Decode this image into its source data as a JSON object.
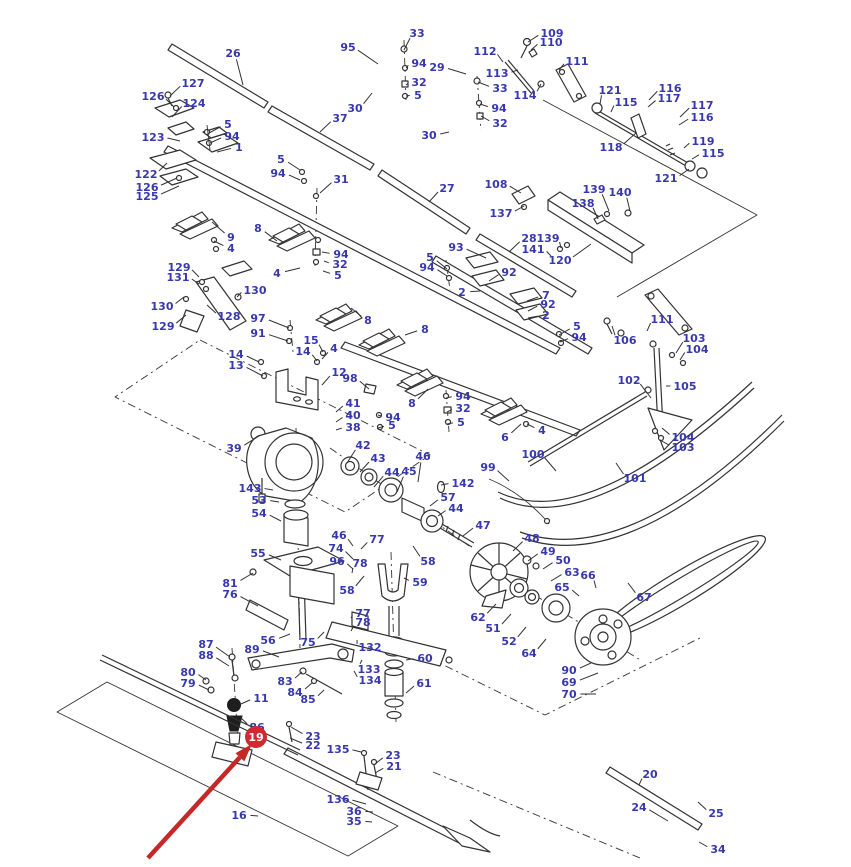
{
  "figure": {
    "label_color": "#3838ae",
    "line_color": "#333333",
    "background": "#ffffff",
    "callout_fields": [
      "text",
      "x",
      "y",
      "leader_x",
      "leader_y"
    ]
  },
  "highlight": {
    "badge_text": "19",
    "badge_color": "#d02a30",
    "badge_text_color": "#ffffff",
    "badge_x": 256,
    "badge_y": 737,
    "badge_r": 11,
    "arrow_color": "#c62828",
    "arrow": {
      "x1": 148,
      "y1": 858,
      "x2": 252,
      "y2": 744
    }
  },
  "callouts": [
    [
      "26",
      233,
      53,
      243,
      85
    ],
    [
      "127",
      193,
      83,
      170,
      96
    ],
    [
      "126",
      153,
      96,
      174,
      107
    ],
    [
      "124",
      194,
      103,
      172,
      117
    ],
    [
      "123",
      153,
      137,
      180,
      141
    ],
    [
      "5",
      228,
      124,
      209,
      133
    ],
    [
      "94",
      232,
      136,
      210,
      143
    ],
    [
      "1",
      239,
      147,
      217,
      152
    ],
    [
      "122",
      146,
      174,
      167,
      163
    ],
    [
      "126",
      147,
      187,
      177,
      178
    ],
    [
      "125",
      147,
      196,
      179,
      186
    ],
    [
      "9",
      231,
      237,
      212,
      222
    ],
    [
      "4",
      231,
      248,
      214,
      241
    ],
    [
      "129",
      179,
      267,
      199,
      277
    ],
    [
      "131",
      178,
      277,
      199,
      284
    ],
    [
      "130",
      255,
      290,
      237,
      297
    ],
    [
      "130",
      162,
      306,
      184,
      297
    ],
    [
      "128",
      229,
      316,
      207,
      305
    ],
    [
      "129",
      163,
      326,
      186,
      315
    ],
    [
      "95",
      348,
      47,
      378,
      64
    ],
    [
      "33",
      417,
      33,
      404,
      50
    ],
    [
      "94",
      419,
      63,
      406,
      68
    ],
    [
      "32",
      419,
      82,
      406,
      85
    ],
    [
      "5",
      418,
      95,
      406,
      96
    ],
    [
      "30",
      355,
      108,
      372,
      93
    ],
    [
      "37",
      340,
      118,
      320,
      132
    ],
    [
      "29",
      437,
      67,
      466,
      74
    ],
    [
      "33",
      500,
      88,
      478,
      82
    ],
    [
      "94",
      499,
      108,
      480,
      104
    ],
    [
      "32",
      500,
      123,
      481,
      116
    ],
    [
      "30",
      429,
      135,
      449,
      132
    ],
    [
      "109",
      552,
      33,
      528,
      42
    ],
    [
      "110",
      551,
      42,
      531,
      50
    ],
    [
      "112",
      485,
      51,
      503,
      62
    ],
    [
      "113",
      497,
      73,
      518,
      70
    ],
    [
      "111",
      577,
      61,
      559,
      70
    ],
    [
      "114",
      525,
      95,
      541,
      84
    ],
    [
      "121",
      610,
      90,
      600,
      104
    ],
    [
      "115",
      626,
      102,
      611,
      112
    ],
    [
      "116",
      670,
      88,
      649,
      100
    ],
    [
      "117",
      669,
      98,
      648,
      107
    ],
    [
      "117",
      702,
      105,
      680,
      117
    ],
    [
      "116",
      702,
      117,
      679,
      125
    ],
    [
      "119",
      703,
      141,
      684,
      148
    ],
    [
      "115",
      713,
      153,
      692,
      159
    ],
    [
      "121",
      666,
      178,
      689,
      169
    ],
    [
      "118",
      611,
      147,
      636,
      133
    ],
    [
      "139",
      594,
      189,
      609,
      211
    ],
    [
      "140",
      620,
      192,
      630,
      211
    ],
    [
      "108",
      496,
      184,
      521,
      193
    ],
    [
      "137",
      501,
      213,
      524,
      206
    ],
    [
      "27",
      447,
      188,
      429,
      202
    ],
    [
      "138",
      583,
      203,
      598,
      219
    ],
    [
      "28",
      529,
      238,
      509,
      252
    ],
    [
      "139",
      548,
      238,
      561,
      248
    ],
    [
      "141",
      533,
      249,
      551,
      256
    ],
    [
      "120",
      560,
      260,
      591,
      244
    ],
    [
      "93",
      456,
      247,
      486,
      258
    ],
    [
      "5",
      430,
      257,
      447,
      269
    ],
    [
      "94",
      427,
      267,
      447,
      276
    ],
    [
      "92",
      509,
      272,
      489,
      281
    ],
    [
      "2",
      462,
      292,
      480,
      291
    ],
    [
      "7",
      546,
      295,
      527,
      301
    ],
    [
      "92",
      548,
      304,
      528,
      311
    ],
    [
      "2",
      546,
      315,
      528,
      318
    ],
    [
      "5",
      577,
      326,
      559,
      335
    ],
    [
      "94",
      579,
      337,
      560,
      342
    ],
    [
      "111",
      662,
      319,
      647,
      331
    ],
    [
      "106",
      625,
      340,
      612,
      326
    ],
    [
      "103",
      694,
      338,
      676,
      353
    ],
    [
      "104",
      697,
      349,
      680,
      360
    ],
    [
      "105",
      685,
      386,
      666,
      386
    ],
    [
      "102",
      629,
      380,
      651,
      398
    ],
    [
      "104",
      683,
      437,
      662,
      428
    ],
    [
      "103",
      683,
      447,
      660,
      440
    ],
    [
      "31",
      341,
      179,
      320,
      193
    ],
    [
      "8",
      258,
      228,
      277,
      241
    ],
    [
      "4",
      277,
      273,
      300,
      268
    ],
    [
      "94",
      341,
      254,
      322,
      252
    ],
    [
      "32",
      340,
      264,
      324,
      261
    ],
    [
      "5",
      338,
      275,
      323,
      271
    ],
    [
      "5",
      281,
      159,
      300,
      170
    ],
    [
      "94",
      278,
      173,
      300,
      180
    ],
    [
      "97",
      258,
      318,
      289,
      328
    ],
    [
      "91",
      258,
      333,
      288,
      341
    ],
    [
      "14",
      236,
      354,
      259,
      362
    ],
    [
      "13",
      236,
      365,
      263,
      376
    ],
    [
      "15",
      311,
      340,
      323,
      352
    ],
    [
      "14",
      303,
      351,
      317,
      361
    ],
    [
      "4",
      334,
      348,
      322,
      359
    ],
    [
      "12",
      339,
      372,
      322,
      385
    ],
    [
      "98",
      350,
      378,
      369,
      389
    ],
    [
      "8",
      368,
      320,
      351,
      308
    ],
    [
      "8",
      425,
      329,
      405,
      335
    ],
    [
      "41",
      353,
      403,
      336,
      412
    ],
    [
      "40",
      353,
      415,
      336,
      422
    ],
    [
      "38",
      353,
      427,
      336,
      430
    ],
    [
      "8",
      412,
      403,
      428,
      389
    ],
    [
      "94",
      463,
      396,
      446,
      398
    ],
    [
      "32",
      463,
      408,
      447,
      412
    ],
    [
      "5",
      461,
      422,
      447,
      424
    ],
    [
      "94",
      393,
      417,
      378,
      415
    ],
    [
      "5",
      392,
      425,
      378,
      428
    ],
    [
      "6",
      505,
      437,
      521,
      424
    ],
    [
      "4",
      542,
      430,
      527,
      424
    ],
    [
      "42",
      363,
      445,
      347,
      463
    ],
    [
      "43",
      378,
      458,
      360,
      472
    ],
    [
      "44",
      392,
      472,
      374,
      487
    ],
    [
      "45",
      409,
      471,
      397,
      492
    ],
    [
      "46",
      423,
      456,
      418,
      482
    ],
    [
      "142",
      463,
      483,
      441,
      485
    ],
    [
      "99",
      488,
      467,
      509,
      481
    ],
    [
      "100",
      533,
      454,
      556,
      471
    ],
    [
      "101",
      635,
      478,
      616,
      463
    ],
    [
      "39",
      234,
      448,
      259,
      436
    ],
    [
      "143",
      250,
      488,
      273,
      490
    ],
    [
      "53",
      259,
      500,
      279,
      502
    ],
    [
      "54",
      259,
      513,
      281,
      521
    ],
    [
      "55",
      258,
      553,
      281,
      560
    ],
    [
      "57",
      448,
      497,
      430,
      506
    ],
    [
      "44",
      456,
      508,
      438,
      516
    ],
    [
      "47",
      483,
      525,
      463,
      536
    ],
    [
      "48",
      532,
      538,
      513,
      551
    ],
    [
      "49",
      548,
      551,
      528,
      561
    ],
    [
      "50",
      563,
      560,
      543,
      569
    ],
    [
      "63",
      572,
      572,
      551,
      581
    ],
    [
      "66",
      588,
      575,
      596,
      588
    ],
    [
      "65",
      562,
      587,
      579,
      596
    ],
    [
      "67",
      644,
      597,
      628,
      583
    ],
    [
      "62",
      478,
      617,
      496,
      604
    ],
    [
      "51",
      493,
      628,
      511,
      614
    ],
    [
      "52",
      509,
      641,
      526,
      627
    ],
    [
      "64",
      529,
      653,
      546,
      639
    ],
    [
      "46",
      339,
      535,
      353,
      546
    ],
    [
      "77",
      377,
      539,
      361,
      549
    ],
    [
      "74",
      336,
      548,
      353,
      559
    ],
    [
      "96",
      337,
      561,
      353,
      569
    ],
    [
      "78",
      360,
      563,
      352,
      573
    ],
    [
      "58",
      428,
      561,
      413,
      546
    ],
    [
      "59",
      420,
      582,
      404,
      578
    ],
    [
      "58",
      347,
      590,
      364,
      576
    ],
    [
      "77",
      363,
      613,
      351,
      618
    ],
    [
      "78",
      363,
      622,
      351,
      631
    ],
    [
      "81",
      230,
      583,
      253,
      573
    ],
    [
      "76",
      230,
      594,
      258,
      606
    ],
    [
      "56",
      268,
      640,
      290,
      634
    ],
    [
      "89",
      252,
      649,
      279,
      657
    ],
    [
      "75",
      308,
      642,
      324,
      632
    ],
    [
      "132",
      370,
      647,
      357,
      640
    ],
    [
      "133",
      369,
      669,
      362,
      660
    ],
    [
      "134",
      370,
      680,
      354,
      671
    ],
    [
      "60",
      425,
      658,
      406,
      660
    ],
    [
      "61",
      424,
      683,
      406,
      693
    ],
    [
      "83",
      285,
      681,
      302,
      672
    ],
    [
      "84",
      295,
      692,
      312,
      683
    ],
    [
      "85",
      308,
      699,
      324,
      690
    ],
    [
      "87",
      206,
      644,
      230,
      657
    ],
    [
      "88",
      206,
      655,
      229,
      666
    ],
    [
      "80",
      188,
      672,
      206,
      680
    ],
    [
      "79",
      188,
      683,
      209,
      690
    ],
    [
      "11",
      261,
      698,
      241,
      704
    ],
    [
      "86",
      257,
      727,
      240,
      717
    ],
    [
      "90",
      569,
      670,
      591,
      663
    ],
    [
      "69",
      569,
      682,
      598,
      673
    ],
    [
      "70",
      569,
      694,
      596,
      694
    ],
    [
      "23",
      313,
      736,
      291,
      727
    ],
    [
      "22",
      313,
      745,
      290,
      738
    ],
    [
      "135",
      338,
      749,
      361,
      752
    ],
    [
      "23",
      393,
      755,
      375,
      764
    ],
    [
      "21",
      394,
      766,
      375,
      773
    ],
    [
      "136",
      338,
      799,
      366,
      804
    ],
    [
      "36",
      354,
      811,
      373,
      812
    ],
    [
      "35",
      354,
      821,
      372,
      822
    ],
    [
      "16",
      239,
      815,
      258,
      816
    ],
    [
      "20",
      650,
      774,
      639,
      785
    ],
    [
      "24",
      639,
      807,
      668,
      821
    ],
    [
      "25",
      716,
      813,
      698,
      802
    ],
    [
      "34",
      718,
      849,
      699,
      842
    ]
  ]
}
